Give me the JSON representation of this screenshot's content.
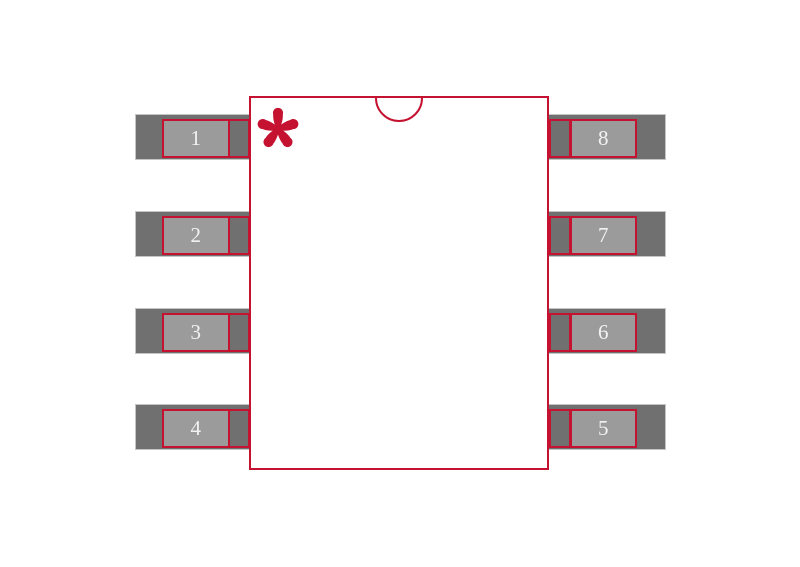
{
  "diagram": {
    "kind": "ic-footprint-land-pattern",
    "pin_count_label": "8"
  },
  "colors": {
    "outline_red": "#c41230",
    "lead_gray": "#707070",
    "lead_edge_gray": "#c5c5c5",
    "pad_gray": "#9b9b9b",
    "pin_number_color": "#f2f2f2",
    "background": "#ffffff"
  },
  "icons": {
    "pin1_marker": "asterisk-icon",
    "index_notch": "semicircle-notch-icon"
  },
  "pins": {
    "left": [
      {
        "number": "1"
      },
      {
        "number": "2"
      },
      {
        "number": "3"
      },
      {
        "number": "4"
      }
    ],
    "right": [
      {
        "number": "8"
      },
      {
        "number": "7"
      },
      {
        "number": "6"
      },
      {
        "number": "5"
      }
    ]
  }
}
